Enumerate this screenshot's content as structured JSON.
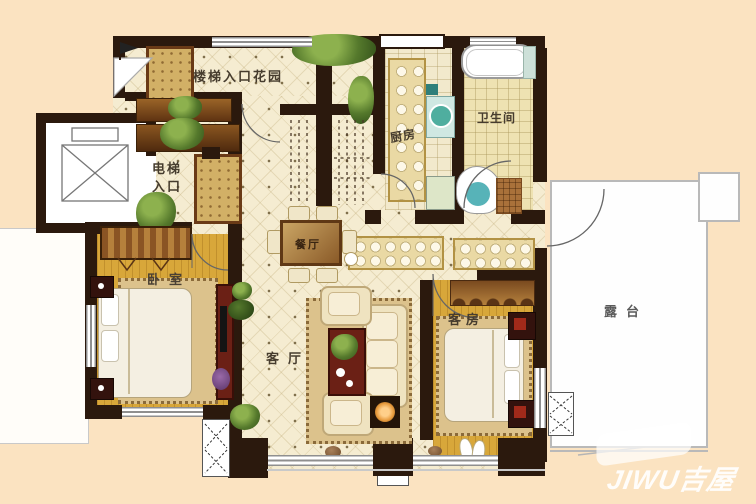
{
  "labels": {
    "garden": "楼梯入口花园",
    "elevator_line1": "电梯",
    "elevator_line2": "入口",
    "kitchen": "厨房",
    "bathroom": "卫生间",
    "dining": "餐厅",
    "bedroom": "卧室",
    "living": "客厅",
    "guest": "客房",
    "terrace": "露台"
  },
  "watermark": {
    "text": "JIWU吉屋"
  },
  "colors": {
    "background": "#fbe3c1",
    "wall": "#2b190d",
    "hall_floor": "#f5ecd1",
    "wood_floor": "#d8a73a",
    "tile_floor": "#f2e9cc",
    "terrace": "#fefefe",
    "accent_red": "#6b2015",
    "teal_fixture": "#57b3b8",
    "cabinet_tan": "#ead9a4"
  }
}
